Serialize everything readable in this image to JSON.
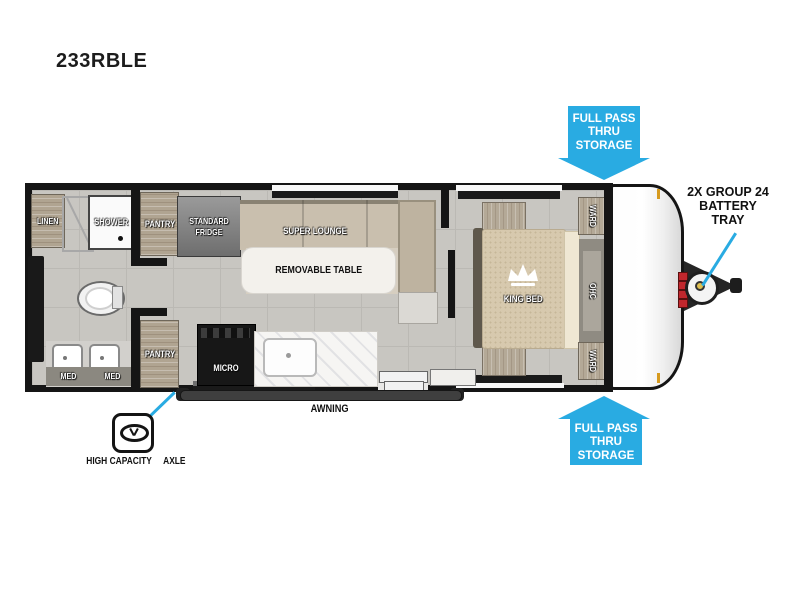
{
  "title": "233RBLE",
  "floorplan": {
    "bathroom": {
      "linen": "LINEN",
      "shower": "SHOWER",
      "med_left": "MED",
      "med_right": "MED"
    },
    "kitchen": {
      "pantry_upper": "PANTRY",
      "fridge": "STANDARD FRIDGE",
      "pantry_lower": "PANTRY",
      "micro": "MICRO"
    },
    "lounge": {
      "sofa": "SUPER LOUNGE",
      "table": "REMOVABLE TABLE"
    },
    "bedroom": {
      "bed": "KING BED",
      "wardrobe_upper": "WARD",
      "overhead_cabinet": "OHC",
      "wardrobe_lower": "WARD"
    }
  },
  "annotations": {
    "storage_top_lines": [
      "FULL PASS",
      "THRU",
      "STORAGE"
    ],
    "storage_bottom_lines": [
      "FULL PASS",
      "THRU",
      "STORAGE"
    ],
    "battery_lines": [
      "2X GROUP 24",
      "BATTERY",
      "TRAY"
    ],
    "axle_lines": [
      "HIGH CAPACITY",
      "AXLE"
    ],
    "awning": "AWNING"
  },
  "colors": {
    "callout_blue": "#29abe2",
    "battery_red": "#c1272d",
    "floor_gray": "#c8c6c1",
    "wood_tan": "#b0a491"
  }
}
